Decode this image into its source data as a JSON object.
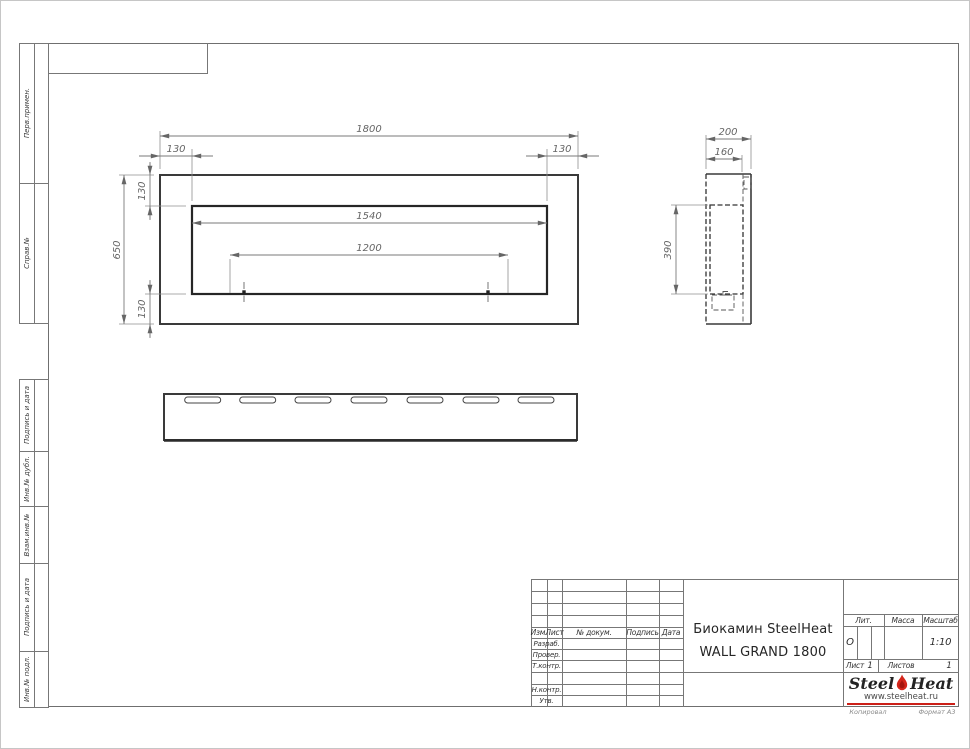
{
  "sheet": {
    "copied_label": "Копировал",
    "format_label": "Формат А3"
  },
  "margin_columns": {
    "items": [
      {
        "label": "Перв.примен."
      },
      {
        "label": "Справ.№"
      },
      {
        "label": "Подпись и дата"
      },
      {
        "label": "Инв.№ дубл."
      },
      {
        "label": "Взам.инв.№"
      },
      {
        "label": "Подпись и дата"
      },
      {
        "label": "Инв.№ подл."
      }
    ]
  },
  "views": {
    "front": {
      "dims": {
        "overall_width": "1800",
        "overall_height": "650",
        "opening_width": "1540",
        "mount_span": "1200",
        "offset_left": "130",
        "offset_right": "130",
        "offset_top": "130",
        "offset_bottom": "130"
      }
    },
    "side": {
      "dims": {
        "depth": "200",
        "inner_depth": "160",
        "opening_height": "390"
      }
    }
  },
  "title_block": {
    "revision_header": {
      "izm": "Изм.",
      "list": "Лист",
      "doc": "№ докум.",
      "sign": "Подпись",
      "date": "Дата"
    },
    "roles": {
      "developer": "Разраб.",
      "checker": "Провер.",
      "tcontrol": "Т.контр.",
      "ncontrol": "Н.контр.",
      "approver": "Утв."
    },
    "title_line1": "Биокамин SteelHeat",
    "title_line2": "WALL GRAND 1800",
    "lit_label": "Лит.",
    "lit_value": "О",
    "mass_label": "Масса",
    "scale_label": "Масштаб",
    "scale_value": "1:10",
    "sheet_label": "Лист",
    "sheet_value": "1",
    "sheets_label": "Листов",
    "sheets_value": "1",
    "logo": {
      "brand_part1": "Steel",
      "brand_part2": "Heat",
      "website": "www.steelheat.ru",
      "flame_color": "#d4261b",
      "accent_color": "#cc2018"
    }
  }
}
